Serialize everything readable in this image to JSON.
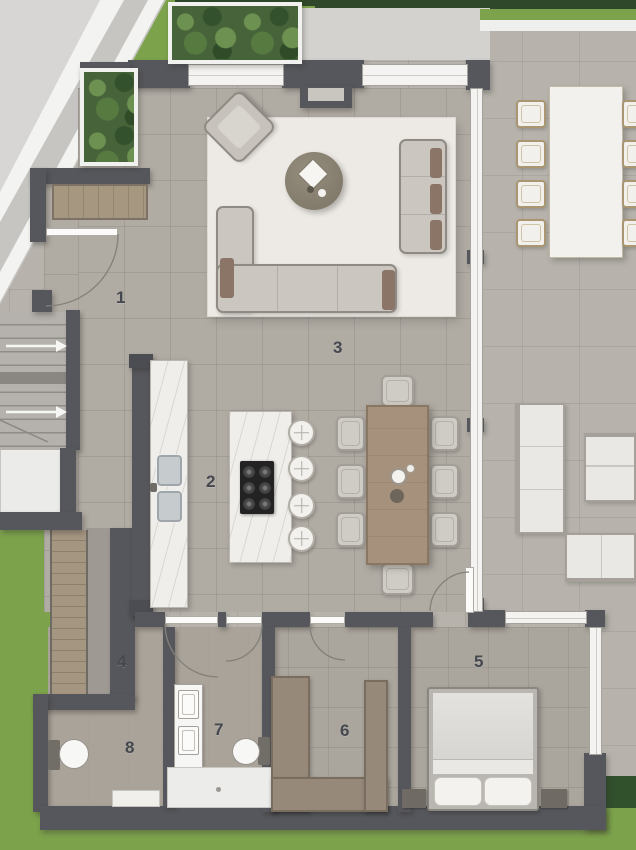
{
  "plan_title": "residential floor plan",
  "rooms": [
    {
      "number": "1"
    },
    {
      "number": "2"
    },
    {
      "number": "3"
    },
    {
      "number": "4"
    },
    {
      "number": "5"
    },
    {
      "number": "6"
    },
    {
      "number": "7"
    },
    {
      "number": "8"
    }
  ],
  "palette": {
    "grass": "#7ca24c",
    "hedge": "#2e4829",
    "paving_outdoor": "#b7b3ac",
    "paving_indoor": "#b0aba3",
    "wall": "#56575c",
    "glass_window": "#f4f3f1",
    "wood_furniture": "#a6917d",
    "wardrobe_wood": "#97897a",
    "marble": "#efeeea",
    "rug": "#edeae5",
    "cooktop": "#232323",
    "accent_pillow": "#8b7566"
  }
}
